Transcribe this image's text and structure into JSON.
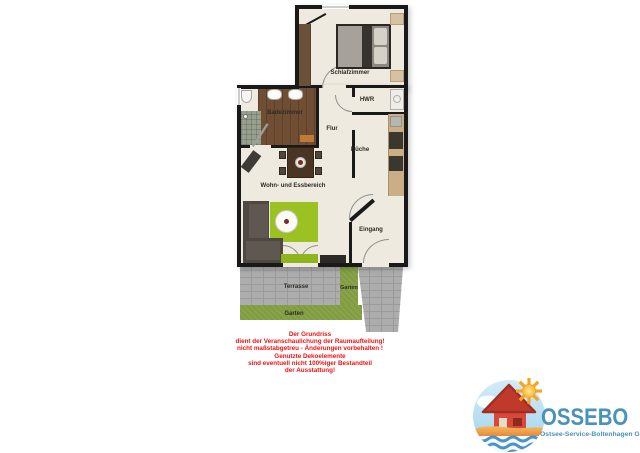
{
  "floorplan": {
    "rooms": {
      "schlafzimmer": "Schlafzimmer",
      "hwr": "HWR",
      "badezimmer": "Badezimmer",
      "flur": "Flur",
      "kueche": "Küche",
      "wohn_essbereich": "Wohn- und Essbereich",
      "eingang": "Eingang"
    },
    "outdoor": {
      "terrasse": "Terrasse",
      "garten_seite": "Garten",
      "garten_unten": "Garten"
    }
  },
  "disclaimer": {
    "lines": [
      "Der Grundriss",
      "dient der Veranschaulichung der Raumaufteilung!",
      "nicht maßstabgetreu - Änderungen vorbehalten !",
      "Genutzte Dekoelemente",
      "sind eventuell nicht 100%iger Bestandteil",
      "der Ausstattung!"
    ],
    "text_color": "#ef1111"
  },
  "logo": {
    "name": "OSSEBO",
    "tagline": "Ostsee-Service-Boltenhagen GmbH",
    "brand_color": "#4a92bb"
  },
  "colors": {
    "wall": "#191919",
    "floor": "#efeadf",
    "rug_green": "#9bc222",
    "garden_green": "#7f9c3e",
    "terrace_grey": "#adadad",
    "bath_wood": "#6f4e33",
    "disclaimer_red": "#ef1111"
  }
}
